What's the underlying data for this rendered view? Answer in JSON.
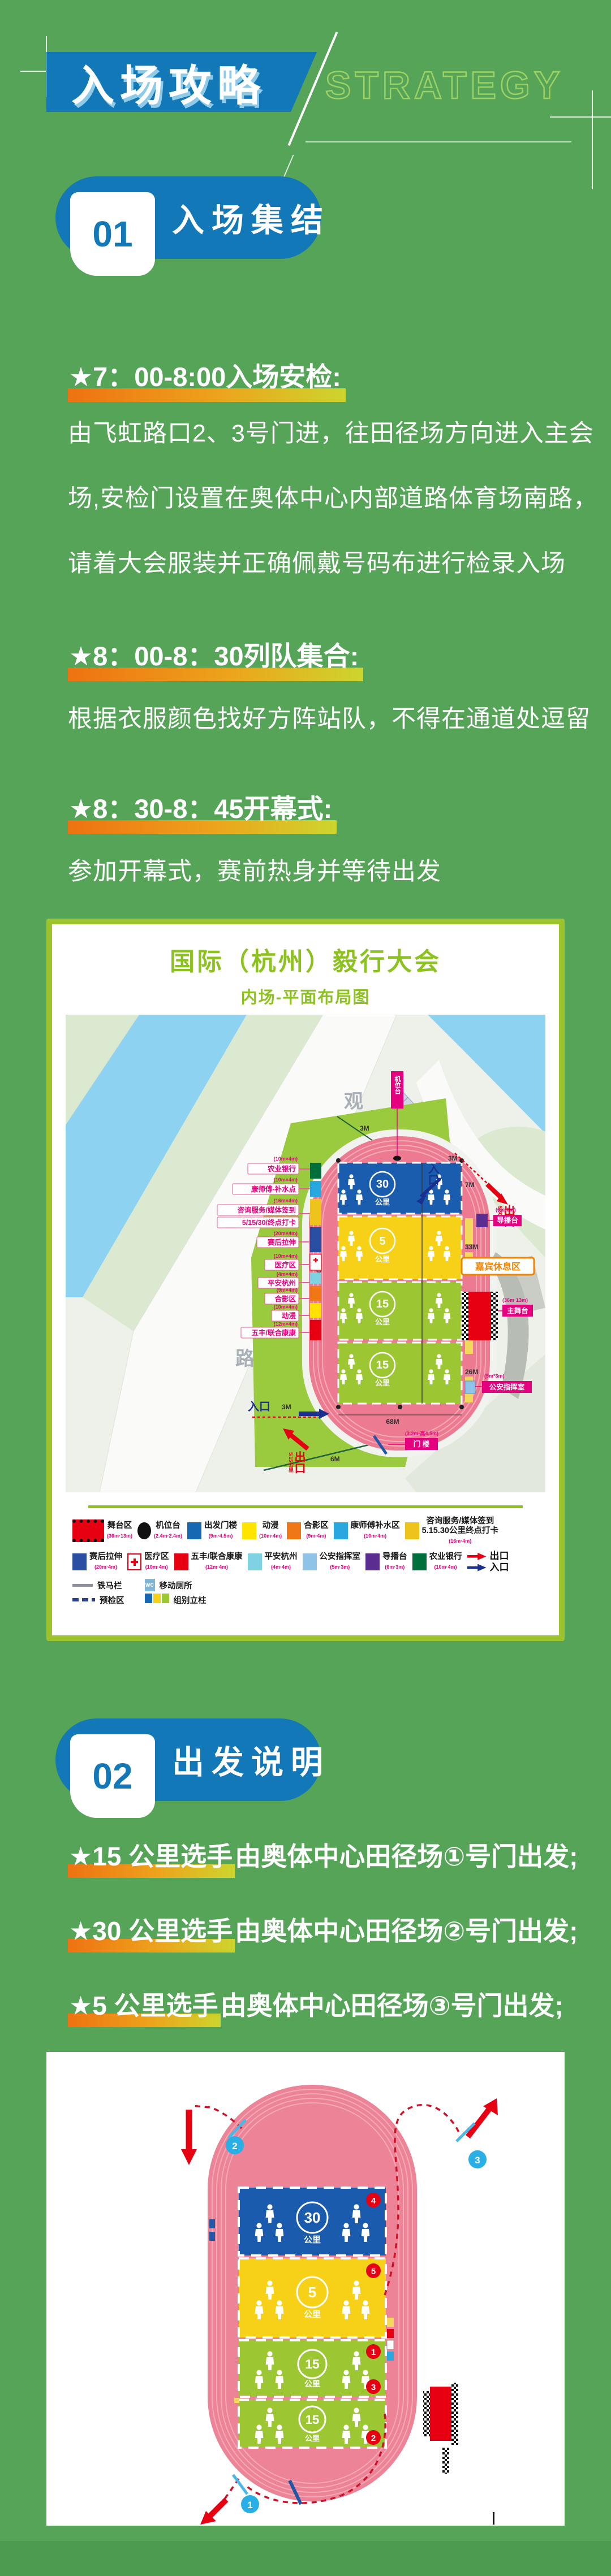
{
  "header": {
    "title": "入场攻略",
    "subtitle": "STRATEGY"
  },
  "sec1": {
    "num": "01",
    "title": "入场集结",
    "h1": "★7：00-8:00入场安检:",
    "p1a": "由飞虹路口2、3号门进，往田径场方向进入主会",
    "p1b": "场,安检门设置在奥体中心内部道路体育场南路，",
    "p1c": "请着大会服装并正确佩戴号码布进行检录入场",
    "h2": "★8：00-8：30列队集合:",
    "p2": "根据衣服颜色找好方阵站队，不得在通道处逗留",
    "h3": "★8：30-8：45开幕式:",
    "p3": "参加开幕式，赛前热身并等待出发"
  },
  "map": {
    "title": "国际（杭州）毅行大会",
    "subtitle": "内场-平面布局图",
    "road1": "观",
    "road2": "澜",
    "road3": "路",
    "camera_label": "机位台",
    "zones": {
      "z30": "30",
      "z5": "5",
      "z15a": "15",
      "z15b": "15",
      "unit": "公里"
    },
    "meas": {
      "m7": "7M",
      "m33": "33M",
      "m26a": "26M",
      "m26b": "26M",
      "m68": "68M",
      "m100": "100M",
      "m3a": "3M",
      "m3b": "3M",
      "m3c": "3M",
      "m6": "6M"
    },
    "left_labels": [
      {
        "size": "(10m×4m)",
        "label": "农业银行"
      },
      {
        "size": "(10m×4m)",
        "label": "康师傅-补水点"
      },
      {
        "size": "(16m×4m)",
        "label": "咨询服务/媒体签到"
      },
      {
        "size": "",
        "label": "5/15/30/终点打卡"
      },
      {
        "size": "(20m×4m)",
        "label": "赛后拉伸"
      },
      {
        "size": "(10m×4m)",
        "label": "医疗区"
      },
      {
        "size": "(4m×4m)",
        "label": "平安杭州"
      },
      {
        "size": "(9m×4m)",
        "label": "合影区"
      },
      {
        "size": "(10m×4m)",
        "label": "动漫"
      },
      {
        "size": "(12m×4m)",
        "label": "五丰/联合康康"
      }
    ],
    "gate": {
      "size": "(3.2m-高4.5m)",
      "label": "门 楼"
    },
    "right": {
      "daobo_size": "(6m*3m)",
      "daobo": "导播台",
      "vip": "嘉宾休息区",
      "stage_size": "(36m·13m)",
      "stage": "主舞台",
      "police_size": "(5m*3m)",
      "police": "公安指挥室"
    },
    "io": {
      "entry": "入口",
      "exit": "出口",
      "exit_note_tr": "5/30公里",
      "exit_note_bl": "5/15公里"
    }
  },
  "legend": {
    "rows": [
      [
        {
          "label": "舞台区",
          "size": "(36m·13m)",
          "color": "#e60012"
        },
        {
          "label": "机位台",
          "size": "(2.4m·2.4m)",
          "color": "#111111"
        },
        {
          "label": "出发门楼",
          "size": "(9m·4.5m)",
          "color": "#1768b3"
        },
        {
          "label": "动漫",
          "size": "(10m·4m)",
          "color": "#ffe400"
        },
        {
          "label": "合影区",
          "size": "(9m·4m)",
          "color": "#ef7716"
        },
        {
          "label": "康师傅补水区",
          "size": "(10m·4m)",
          "color": "#29a8e0"
        },
        {
          "label": "咨询服务/媒体签到",
          "label2": "5.15.30公里终点打卡",
          "size": "(16m·4m)",
          "color": "#eec31c"
        }
      ],
      [
        {
          "label": "赛后拉伸",
          "size": "(20m·4m)",
          "color": "#2a4ea2"
        },
        {
          "label": "医疗区",
          "size": "(10m·4m)",
          "color": "#ffffff"
        },
        {
          "label": "五丰/联合康康",
          "size": "(12m·4m)",
          "color": "#e60012"
        },
        {
          "label": "平安杭州",
          "size": "(4m·4m)",
          "color": "#7ed2e2"
        },
        {
          "label": "公安指挥室",
          "size": "(5m·3m)",
          "color": "#8fc3e8"
        },
        {
          "label": "导播台",
          "size": "(6m·3m)",
          "color": "#5b2d90"
        },
        {
          "label": "农业银行",
          "size": "(10m·4m)",
          "color": "#006f3c"
        },
        {
          "exit": "出口",
          "entry": "入口",
          "exit_color": "#e60012",
          "entry_color": "#1b2f8e"
        }
      ],
      [
        {
          "label": "铁马栏"
        },
        {
          "label": "移动厕所",
          "wc": "WC"
        },
        {
          "label": "预检区"
        },
        {
          "label": "组别立柱"
        }
      ]
    ]
  },
  "sec2": {
    "num": "02",
    "title": "出发说明",
    "lines": [
      {
        "strong": "★15 公里选手",
        "rest": "由奥体中心田径场①号门出发;"
      },
      {
        "strong": "★30 公里选手",
        "rest": "由奥体中心田径场②号门出发;"
      },
      {
        "strong": "★5 公里选手",
        "rest": "由奥体中心田径场③号门出发;"
      }
    ]
  },
  "diagram": {
    "z30": "30",
    "z5": "5",
    "z15a": "15",
    "z15b": "15",
    "unit": "公里",
    "g1": "1",
    "g2": "2",
    "g3": "3",
    "c1": "1",
    "c2": "2",
    "c3": "3",
    "c4": "4",
    "c5": "5"
  }
}
